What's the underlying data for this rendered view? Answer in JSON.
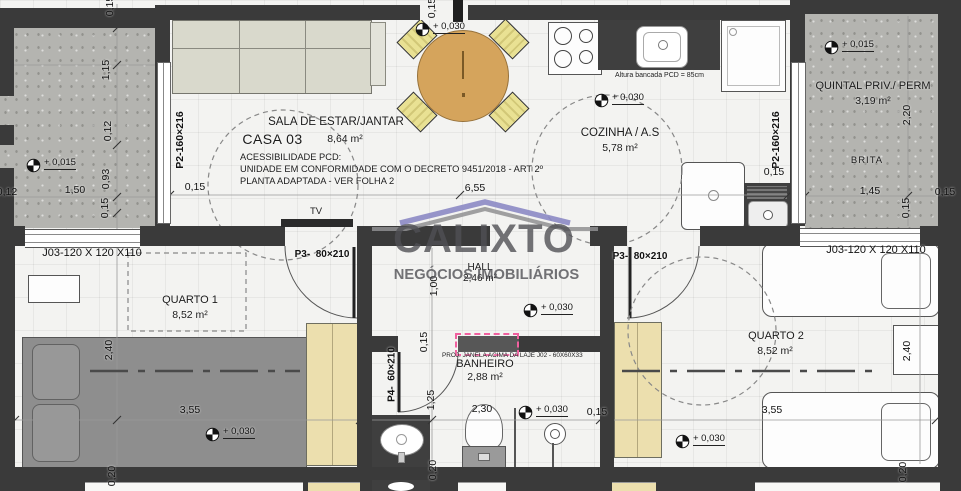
{
  "labels": {
    "casa": "CASA 03",
    "sala": {
      "name": "SALA DE ESTAR/JANTAR",
      "area": "8,64 m²"
    },
    "cozinha": {
      "name": "COZINHA / A.S",
      "area": "5,78 m²"
    },
    "quintal": {
      "name": "QUINTAL PRIV./ PERM",
      "area": "3,19 m²",
      "floor": "BRITA"
    },
    "hall": {
      "name": "HALL",
      "area": "2,46 m²"
    },
    "quarto1": {
      "name": "QUARTO 1",
      "area": "8,52 m²"
    },
    "quarto2": {
      "name": "QUARTO 2",
      "area": "8,52 m²"
    },
    "banheiro": {
      "name": "BANHEIRO",
      "area": "2,88 m²"
    }
  },
  "notes": {
    "acc1": "ACESSIBILIDADE PCD:",
    "acc2": "UNIDADE EM CONFORMIDADE COM O DECRETO 9451/2018 - ART 2º",
    "acc3": "PLANTA ADAPTADA - VER FOLHA 2",
    "bancada": "Altura bancada PCD = 85cm",
    "proj_janela": "PROJ. JANELA ACIMA DA LAJE J02 - 60X60X33",
    "tv": "TV"
  },
  "openings": {
    "p2_left": "P2-160×216",
    "p2_right": "P2-160×216",
    "p3_left": "P3-  80×210",
    "p3_right": "P3-  80×210",
    "p4": "P4-  60×210",
    "j03_left": "J03-120 X 120 X110",
    "j03_right": "J03-120 X 120 X110"
  },
  "levels": {
    "quintal_left": "+ 0,015",
    "quintal_right": "+ 0,015",
    "sala": "+ 0,030",
    "cozinha": "+ 0,030",
    "hall": "+ 0,030",
    "banheiro": "+ 0,030",
    "quarto1": "+ 0,030",
    "quarto2": "+ 0,030"
  },
  "dims": {
    "top_left_015": "0,15",
    "left_115": "1,15",
    "left_012": "0,12",
    "left_093": "0,93",
    "left_bottom_015": "0,15",
    "left_150": "1,50",
    "left_edge_012": "0,12",
    "sala_015": "0,15",
    "sala_655": "6,55",
    "top_mid_015": "0,15",
    "cozinha_right_015": "0,15",
    "qr_220": "2,20",
    "qr_145": "1,45",
    "qr_015_v": "0,15",
    "qr_015_h": "0,15",
    "hall_100": "1,00",
    "ban_015_v": "0,15",
    "ban_125": "1,25",
    "ban_230": "2,30",
    "ban_015_r": "0,15",
    "ban_020": "0,20",
    "q1_240": "2,40",
    "q1_355": "3,55",
    "q1_020": "0,20",
    "q2_240": "2,40",
    "q2_355": "3,55",
    "q2_020": "0,20"
  },
  "watermark": {
    "brand": "CALIXTO",
    "tagline": "NEGÓCIOS IMOBILIÁRIOS"
  },
  "colors": {
    "wall": "#3a3a3a",
    "window_proj_pink": "#f0609f",
    "watermark_gray": "#50505580",
    "roof_purple": "#8c89c4",
    "wardrobe": "#ecdfae",
    "table": "#d5a45c"
  }
}
